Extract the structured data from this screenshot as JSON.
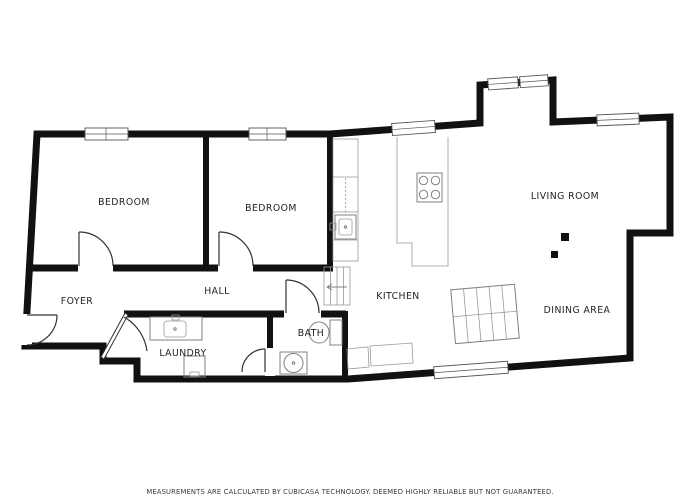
{
  "floor_plan": {
    "title": "apartment-floor-plan",
    "rooms": [
      {
        "id": "bedroom-1",
        "label": "BEDROOM"
      },
      {
        "id": "bedroom-2",
        "label": "BEDROOM"
      },
      {
        "id": "living-room",
        "label": "LIVING ROOM"
      },
      {
        "id": "kitchen",
        "label": "KITCHEN"
      },
      {
        "id": "dining-area",
        "label": "DINING AREA"
      },
      {
        "id": "hall",
        "label": "HALL"
      },
      {
        "id": "foyer",
        "label": "FOYER"
      },
      {
        "id": "laundry",
        "label": "LAUNDRY"
      },
      {
        "id": "bath",
        "label": "BATH"
      }
    ],
    "disclaimer": "MEASUREMENTS ARE CALCULATED BY CUBICASA TECHNOLOGY. DEEMED HIGHLY RELIABLE BUT NOT GUARANTEED.",
    "colors": {
      "wall": "#111111",
      "background": "#ffffff",
      "label_text": "#222222",
      "disclaimer_text": "#3a3a3a",
      "door_line": "#333333",
      "window_border": "#555555",
      "fixture_line": "#808080"
    }
  }
}
